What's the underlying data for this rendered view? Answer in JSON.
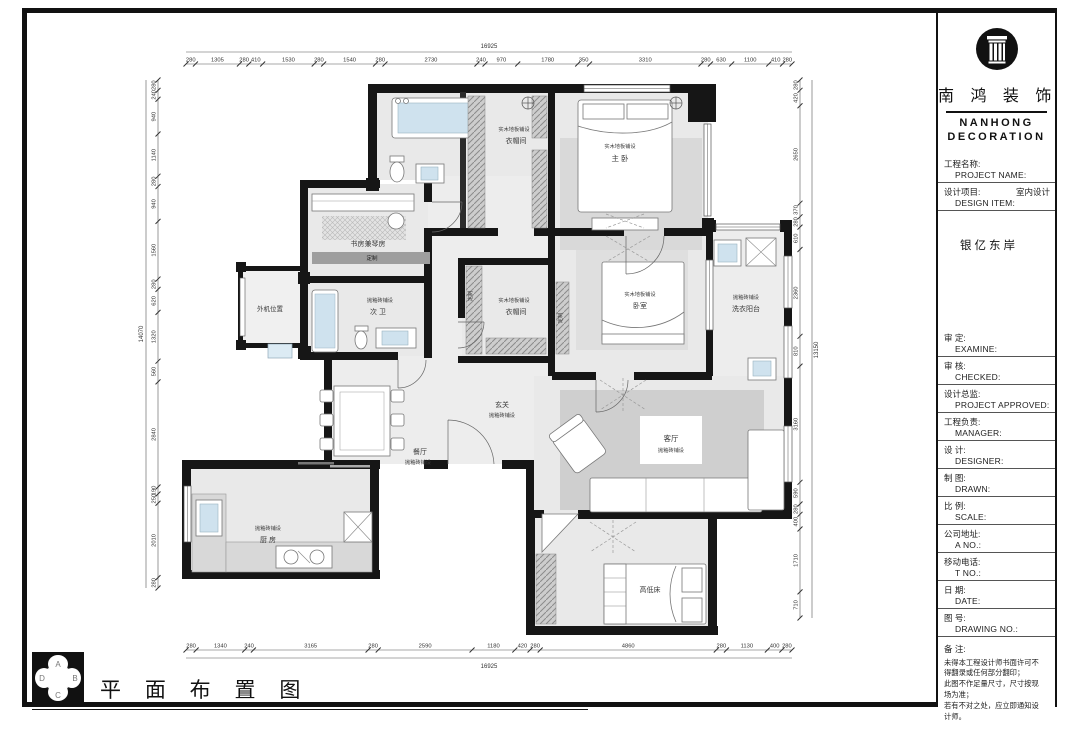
{
  "company": {
    "name_cn": "南 鸿 装 饰",
    "name_en_line1": "NANHONG",
    "name_en_line2": "DECORATION",
    "logo": "column-logo"
  },
  "title_block": {
    "rows_top": [
      {
        "cn": "工程名称:",
        "en": "PROJECT NAME:",
        "value": ""
      },
      {
        "cn": "设计项目:",
        "en": "DESIGN ITEM:",
        "value": "室内设计"
      }
    ],
    "project_name_value": "银亿东岸",
    "rows_main": [
      {
        "cn": "审 定:",
        "en": "EXAMINE:",
        "value": ""
      },
      {
        "cn": "审 核:",
        "en": "CHECKED:",
        "value": ""
      },
      {
        "cn": "设计总监:",
        "en": "PROJECT APPROVED:",
        "value": ""
      },
      {
        "cn": "工程负责:",
        "en": "MANAGER:",
        "value": ""
      },
      {
        "cn": "设 计:",
        "en": "DESIGNER:",
        "value": ""
      },
      {
        "cn": "制 图:",
        "en": "DRAWN:",
        "value": ""
      },
      {
        "cn": "比 例:",
        "en": "SCALE:",
        "value": ""
      },
      {
        "cn": "公司地址:",
        "en": "A  NO.:",
        "value": ""
      },
      {
        "cn": "移动电话:",
        "en": "T  NO.:",
        "value": ""
      },
      {
        "cn": "日 期:",
        "en": "DATE:",
        "value": ""
      },
      {
        "cn": "图 号:",
        "en": "DRAWING NO.:",
        "value": ""
      }
    ],
    "remarks": {
      "label": "备 注:",
      "lines": [
        "未得本工程设计师书面许可不",
        "得翻录或任何部分翻印；",
        "此图不作足量尺寸，尺寸按现",
        "场为准；",
        "若有不对之处，应立即通知设",
        "计师。"
      ]
    }
  },
  "drawing_title": "平 面 布 置 图",
  "compass": {
    "top": "A",
    "right": "B",
    "bottom": "C",
    "left": "D"
  },
  "rooms": {
    "cloakroom1": {
      "material": "实木地板铺设",
      "name": "衣帽间"
    },
    "master_bedroom": {
      "material": "实木地板铺设",
      "name": "主 卧"
    },
    "study": {
      "material": "",
      "name": "书房兼琴房"
    },
    "second_bath": {
      "material": "抛釉砖铺设",
      "name": "次 卫"
    },
    "ac_unit": {
      "material": "",
      "name": "外机位置"
    },
    "cloakroom2": {
      "material": "实木地板铺设",
      "name": "衣帽间"
    },
    "bedroom": {
      "material": "实木地板铺设",
      "name": "卧室"
    },
    "laundry": {
      "material": "抛釉砖铺设",
      "name": "洗衣阳台"
    },
    "entry": {
      "material": "抛釉砖铺设",
      "name": "玄关"
    },
    "living": {
      "material": "抛釉砖铺设",
      "name": "客厅"
    },
    "dining": {
      "material": "抛釉砖铺设",
      "name": "餐厅"
    },
    "kitchen": {
      "material": "抛釉砖铺设",
      "name": "厨 房"
    },
    "kids_room": {
      "material": "",
      "name": "高低床"
    }
  },
  "labels": {
    "custom": "定制"
  },
  "dimensions": {
    "top": {
      "total": "16925",
      "segments": [
        "280",
        "1305",
        "280",
        "410",
        "1530",
        "280",
        "1540",
        "280",
        "2730",
        "240",
        "970",
        "1780",
        "350",
        "3310",
        "280",
        "630",
        "1100",
        "410",
        "280"
      ]
    },
    "bottom": {
      "total": "16925",
      "segments": [
        "280",
        "1340",
        "240",
        "3165",
        "280",
        "2590",
        "1180",
        "420",
        "280",
        "4860",
        "280",
        "1130",
        "400",
        "280"
      ]
    },
    "left": {
      "total": "14070",
      "segments": [
        "280",
        "240",
        "940",
        "1140",
        "280",
        "940",
        "1560",
        "280",
        "620",
        "1320",
        "560",
        "2840",
        "190",
        "250",
        "2010",
        "280"
      ]
    },
    "right": {
      "total": "13150",
      "segments": [
        "280",
        "420",
        "2650",
        "370",
        "280",
        "610",
        "2360",
        "810",
        "3160",
        "590",
        "280",
        "400",
        "1710",
        "710"
      ]
    }
  },
  "colors": {
    "wall": "#161616",
    "floor": "#e9e9e9",
    "rug": "#d2d2d2",
    "fixture_blue": "#cfe2ee",
    "accent_gray": "#9e9e9e"
  }
}
